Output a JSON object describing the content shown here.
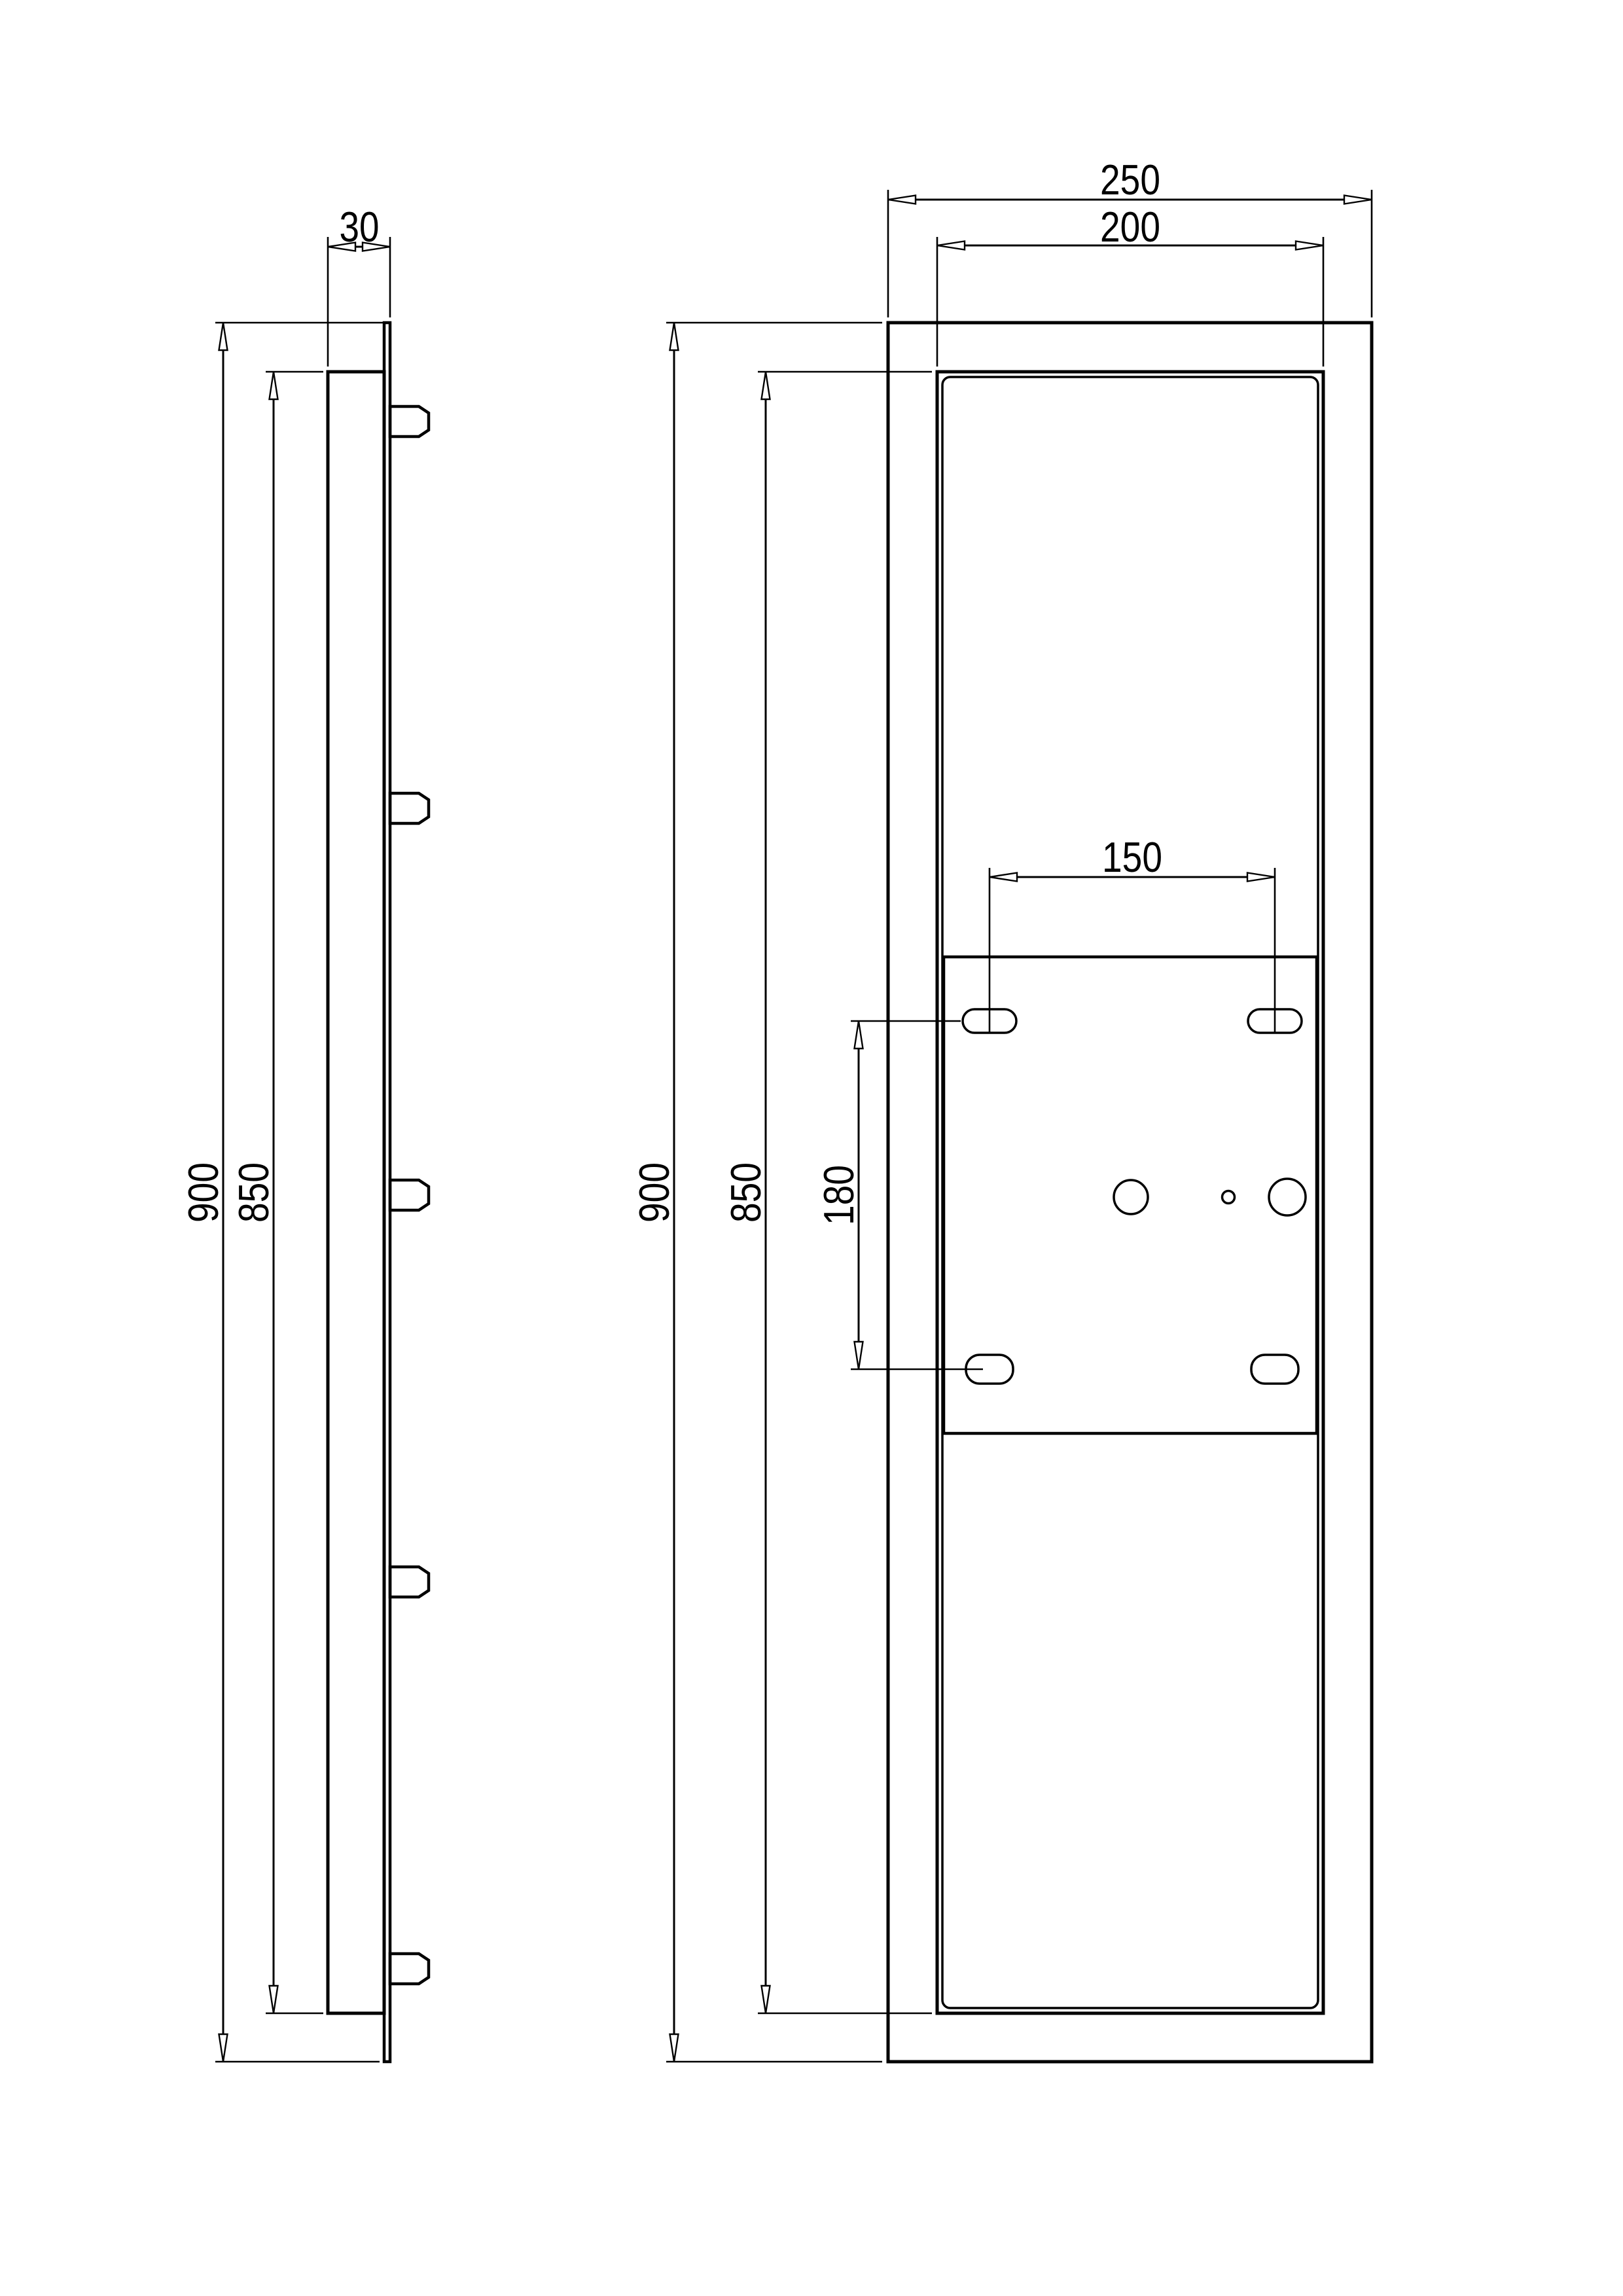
{
  "sheet": {
    "background": "#ffffff",
    "line_color": "#000000",
    "views": 2
  },
  "side_view": {
    "dim_depth": "30",
    "dim_outer_height": "900",
    "dim_inner_height": "850",
    "mounting_tab_count": 5
  },
  "front_view": {
    "dim_outer_width": "250",
    "dim_inner_width": "200",
    "dim_outer_height": "900",
    "dim_inner_height": "850",
    "dim_slot_spacing_horizontal": "150",
    "dim_slot_spacing_vertical": "180",
    "slot_count": 4,
    "hole_count": 3
  }
}
